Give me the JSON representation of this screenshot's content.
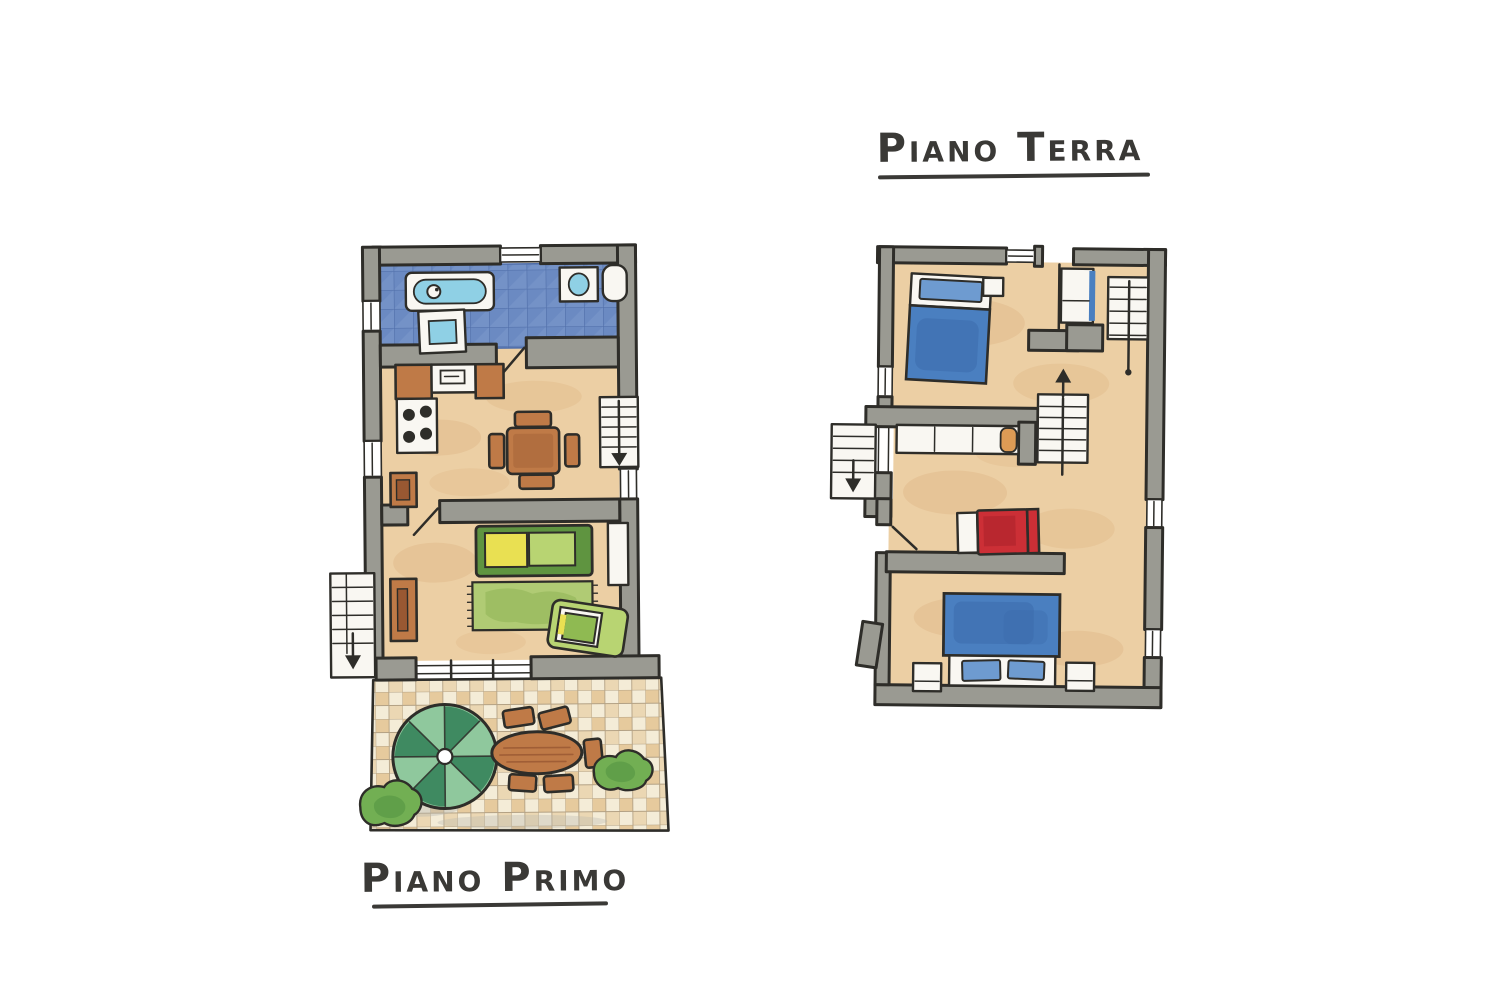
{
  "page": {
    "background": "#ffffff"
  },
  "plans": {
    "piano_primo": {
      "title": "Piano Primo",
      "rooms": [
        "bathroom",
        "kitchen-dining",
        "living-room",
        "terrace"
      ],
      "features": [
        "bathtub",
        "washing-machine",
        "bathroom-sink",
        "toilet",
        "stove",
        "kitchen-counter-with-sink",
        "dining-table-with-chairs",
        "interior-staircase-down",
        "kitchen-cabinet",
        "sofa",
        "rug",
        "armchair",
        "sideboard",
        "wall-console",
        "exterior-staircase-down",
        "parasol",
        "terrace-table-with-chairs",
        "bush",
        "bush"
      ]
    },
    "piano_terra": {
      "title": "Piano Terra",
      "rooms": [
        "bedroom-north",
        "entry-hall",
        "bedroom-middle",
        "bedroom-south"
      ],
      "features": [
        "double-bed-blue",
        "bedside-table",
        "entry-door",
        "exterior-staircase-northeast",
        "interior-staircase-up",
        "wardrobe",
        "single-bed-red",
        "exterior-staircase-west",
        "door-swing",
        "double-bed-blue",
        "nightstand",
        "nightstand"
      ]
    }
  },
  "colors": {
    "paper": "#ffffff",
    "title": "#3a3936",
    "ink": "#2e2d29",
    "wall": "#9a9a92",
    "wall_shade": "#84847c",
    "floor": "#eccfa4",
    "floor_shade": "#dfb585",
    "tile_blue": "#6b8ac2",
    "tile_line": "#4e6ca7",
    "tile_light": "#8aa5d2",
    "fixture": "#f9f7f2",
    "water": "#8fd0e5",
    "bed_blue": "#4a7fc0",
    "bed_blue_deep": "#3a69a9",
    "pillow_blue": "#6e9bd0",
    "bed_red": "#cc2f36",
    "bed_red_deep": "#a21f27",
    "sofa_green": "#8fba52",
    "sofa_green_deep": "#5f9440",
    "cushion_yellow": "#e9e052",
    "cushion_green": "#b8d472",
    "rug_green": "#b0cb74",
    "rug_green_deep": "#8fb556",
    "wood": "#bf7a47",
    "wood_deep": "#995832",
    "parasol_dark": "#3f8a61",
    "parasol_light": "#8fc89d",
    "bush": "#72af53",
    "bush_deep": "#4d8f3f",
    "terrace_cream": "#f4ecd7",
    "terrace_tan": "#e2c28f",
    "terrace_line": "#b3a184",
    "wardrobe_orange": "#dd9b55",
    "shadow": "#b6b6b0"
  }
}
